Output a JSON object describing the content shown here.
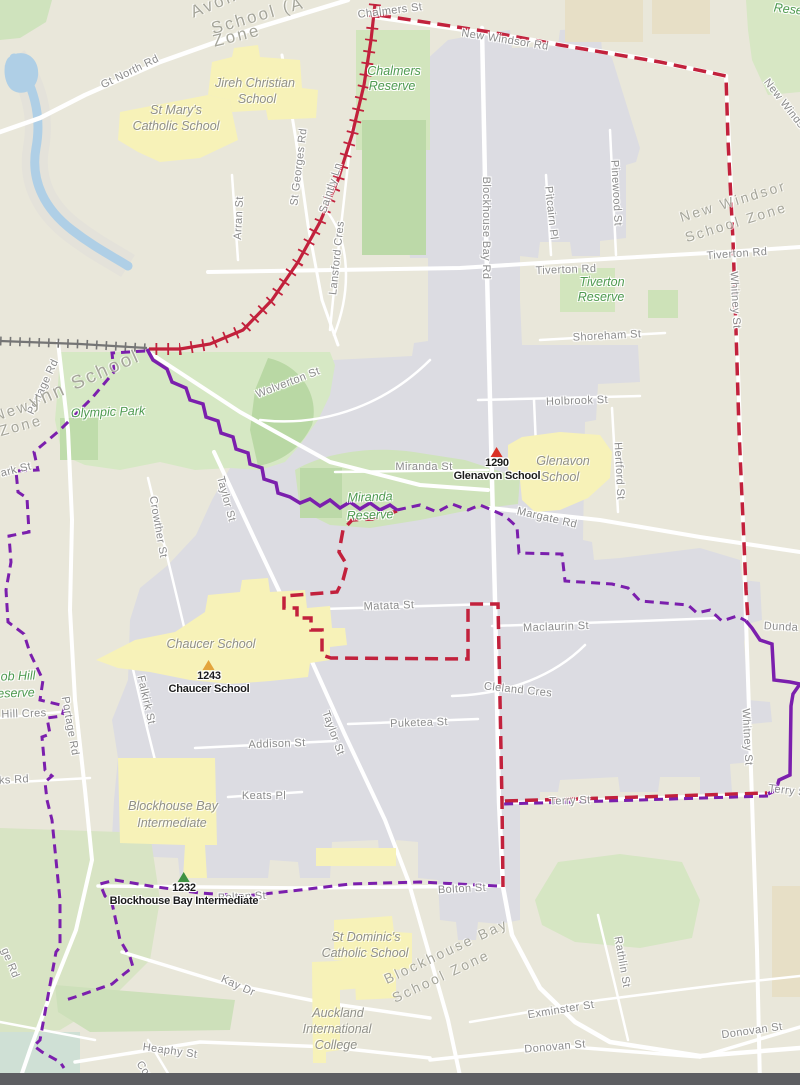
{
  "colors": {
    "land": "#e9e7da",
    "zone_fill": "#dcdce2",
    "park": "#d2e5bd",
    "park_dark": "#b9d8a4",
    "water": "#afcfe6",
    "teal": "#cfe0d5",
    "school_yellow": "#f7f2b8",
    "khaki": "#e7dfc6",
    "road": "#ffffff",
    "red_boundary": "#c2213c",
    "purple_boundary": "#7b1fad",
    "railway": "#757575",
    "bottom_bar": "#5d5e62"
  },
  "markers": [
    {
      "num": "1290",
      "name": "Glenavon School",
      "x": 497,
      "y": 447,
      "color": "#d93025"
    },
    {
      "num": "1243",
      "name": "Chaucer School",
      "x": 209,
      "y": 660,
      "color": "#e3a43c"
    },
    {
      "num": "1232",
      "name": "Blockhouse Bay Intermediate",
      "x": 184,
      "y": 872,
      "color": "#3f9142"
    }
  ],
  "labels": [
    {
      "t": "Chalmers St",
      "x": 390,
      "y": 11,
      "r": -7,
      "c": "st"
    },
    {
      "t": "New Windsor Rd",
      "x": 505,
      "y": 40,
      "r": 9,
      "c": "st"
    },
    {
      "t": "Gt North Rd",
      "x": 130,
      "y": 72,
      "r": -26,
      "c": "st"
    },
    {
      "t": "New Windsor Rd",
      "x": 793,
      "y": 115,
      "r": 52,
      "c": "st"
    },
    {
      "t": "St Georges Rd",
      "x": 299,
      "y": 167,
      "r": -83,
      "c": "st"
    },
    {
      "t": "Saintly Ln",
      "x": 331,
      "y": 188,
      "r": -72,
      "c": "st"
    },
    {
      "t": "Arran St",
      "x": 239,
      "y": 218,
      "r": -87,
      "c": "st"
    },
    {
      "t": "Lansford Cres",
      "x": 337,
      "y": 258,
      "r": -84,
      "c": "st"
    },
    {
      "t": "Blockhouse Bay Rd",
      "x": 486,
      "y": 228,
      "r": 90,
      "c": "st"
    },
    {
      "t": "Pitcairn Pl",
      "x": 551,
      "y": 213,
      "r": 84,
      "c": "st"
    },
    {
      "t": "Pinewood St",
      "x": 616,
      "y": 193,
      "r": 87,
      "c": "st"
    },
    {
      "t": "Tiverton Rd",
      "x": 566,
      "y": 270,
      "r": -2,
      "c": "st"
    },
    {
      "t": "Tiverton Rd",
      "x": 737,
      "y": 254,
      "r": -4,
      "c": "st"
    },
    {
      "t": "Whitney St",
      "x": 735,
      "y": 300,
      "r": 87,
      "c": "st"
    },
    {
      "t": "Shoreham St",
      "x": 607,
      "y": 336,
      "r": -3,
      "c": "st"
    },
    {
      "t": "Wolverton St",
      "x": 288,
      "y": 383,
      "r": -21,
      "c": "st"
    },
    {
      "t": "Holbrook St",
      "x": 577,
      "y": 401,
      "r": -2,
      "c": "st"
    },
    {
      "t": "Miranda St",
      "x": 424,
      "y": 467,
      "r": 0,
      "c": "st"
    },
    {
      "t": "Hertford St",
      "x": 619,
      "y": 471,
      "r": 87,
      "c": "st"
    },
    {
      "t": "Margate Rd",
      "x": 547,
      "y": 518,
      "r": 13,
      "c": "st"
    },
    {
      "t": "Crowther St",
      "x": 158,
      "y": 527,
      "r": 80,
      "c": "st"
    },
    {
      "t": "Taylor St",
      "x": 226,
      "y": 499,
      "r": 75,
      "c": "st"
    },
    {
      "t": "Matata St",
      "x": 389,
      "y": 606,
      "r": -2,
      "c": "st"
    },
    {
      "t": "Maclaurin St",
      "x": 556,
      "y": 627,
      "r": -2,
      "c": "st"
    },
    {
      "t": "Falkirk St",
      "x": 146,
      "y": 700,
      "r": 77,
      "c": "st"
    },
    {
      "t": "Cleland Cres",
      "x": 518,
      "y": 690,
      "r": 6,
      "c": "st"
    },
    {
      "t": "Puketea St",
      "x": 419,
      "y": 723,
      "r": -2,
      "c": "st"
    },
    {
      "t": "Addison St",
      "x": 277,
      "y": 744,
      "r": -2,
      "c": "st"
    },
    {
      "t": "Taylor St",
      "x": 333,
      "y": 733,
      "r": 70,
      "c": "st"
    },
    {
      "t": "Keats Pl",
      "x": 264,
      "y": 796,
      "r": 0,
      "c": "st"
    },
    {
      "t": "Whitney St",
      "x": 747,
      "y": 737,
      "r": 87,
      "c": "st"
    },
    {
      "t": "Terry St",
      "x": 789,
      "y": 791,
      "r": 7,
      "c": "st"
    },
    {
      "t": "Terry St",
      "x": 570,
      "y": 801,
      "r": -2,
      "c": "st"
    },
    {
      "t": "Dunda",
      "x": 781,
      "y": 627,
      "r": 3,
      "c": "st"
    },
    {
      "t": "Bolton St",
      "x": 242,
      "y": 897,
      "r": -3,
      "c": "st"
    },
    {
      "t": "Bolton St",
      "x": 462,
      "y": 889,
      "r": -3,
      "c": "st"
    },
    {
      "t": "Kay Dr",
      "x": 238,
      "y": 986,
      "r": 24,
      "c": "st"
    },
    {
      "t": "Heaphy St",
      "x": 170,
      "y": 1051,
      "r": 8,
      "c": "st"
    },
    {
      "t": "Rathlin St",
      "x": 622,
      "y": 962,
      "r": 80,
      "c": "st"
    },
    {
      "t": "Exminster St",
      "x": 561,
      "y": 1010,
      "r": -9,
      "c": "st"
    },
    {
      "t": "Donovan St",
      "x": 555,
      "y": 1047,
      "r": -5,
      "c": "st"
    },
    {
      "t": "Donovan St",
      "x": 752,
      "y": 1031,
      "r": -8,
      "c": "st"
    },
    {
      "t": "Portage Rd",
      "x": 43,
      "y": 387,
      "r": -65,
      "c": "st"
    },
    {
      "t": "Portage Rd",
      "x": 70,
      "y": 726,
      "r": 80,
      "c": "st"
    },
    {
      "t": "ge Rd",
      "x": 10,
      "y": 963,
      "r": 68,
      "c": "st"
    },
    {
      "t": "ark St",
      "x": 16,
      "y": 470,
      "r": -14,
      "c": "st"
    },
    {
      "t": "Hill Cres",
      "x": 24,
      "y": 714,
      "r": -2,
      "c": "st"
    },
    {
      "t": "ks Rd",
      "x": 14,
      "y": 780,
      "r": -3,
      "c": "st"
    },
    {
      "t": "Cor",
      "x": 144,
      "y": 1070,
      "r": 55,
      "c": "st"
    },
    {
      "t": "Avon",
      "x": 214,
      "y": 4,
      "r": -22,
      "c": "zn",
      "s": 17
    },
    {
      "t": "School (A",
      "x": 258,
      "y": 16,
      "r": -16,
      "c": "zn",
      "s": 17
    },
    {
      "t": "Zone",
      "x": 237,
      "y": 36,
      "r": -14,
      "c": "zn",
      "s": 17
    },
    {
      "t": "New Windsor",
      "x": 733,
      "y": 201,
      "r": -17,
      "c": "zn"
    },
    {
      "t": "School Zone",
      "x": 736,
      "y": 222,
      "r": -17,
      "c": "zn"
    },
    {
      "t": "ynn School",
      "x": 85,
      "y": 380,
      "r": -24,
      "c": "zn",
      "s": 19
    },
    {
      "t": "New",
      "x": 12,
      "y": 411,
      "r": -18,
      "c": "zn",
      "s": 15
    },
    {
      "t": "Zone",
      "x": 21,
      "y": 426,
      "r": -15,
      "c": "zn",
      "s": 15
    },
    {
      "t": "Blockhouse Bay",
      "x": 446,
      "y": 951,
      "r": -25,
      "c": "zn"
    },
    {
      "t": "School Zone",
      "x": 441,
      "y": 976,
      "r": -25,
      "c": "zn"
    },
    {
      "t": "Chalmers",
      "x": 394,
      "y": 71,
      "r": 0,
      "c": "rv"
    },
    {
      "t": "Reserve",
      "x": 392,
      "y": 86,
      "r": 0,
      "c": "rv"
    },
    {
      "t": "Reserve",
      "x": 797,
      "y": 10,
      "r": 6,
      "c": "rv"
    },
    {
      "t": "Tiverton",
      "x": 602,
      "y": 282,
      "r": 0,
      "c": "rv"
    },
    {
      "t": "Reserve",
      "x": 601,
      "y": 297,
      "r": 0,
      "c": "rv"
    },
    {
      "t": "Olympic Park",
      "x": 108,
      "y": 412,
      "r": -2,
      "c": "rv"
    },
    {
      "t": "Miranda",
      "x": 370,
      "y": 497,
      "r": -2,
      "c": "rv"
    },
    {
      "t": "Reserve",
      "x": 370,
      "y": 515,
      "r": -2,
      "c": "rv"
    },
    {
      "t": "ob Hill",
      "x": 18,
      "y": 676,
      "r": -2,
      "c": "rv"
    },
    {
      "t": "eserve",
      "x": 16,
      "y": 693,
      "r": -2,
      "c": "rv"
    },
    {
      "t": "Jireh Christian",
      "x": 255,
      "y": 83,
      "r": 0,
      "c": "sc"
    },
    {
      "t": "School",
      "x": 257,
      "y": 99,
      "r": 0,
      "c": "sc"
    },
    {
      "t": "St Mary's",
      "x": 176,
      "y": 110,
      "r": 0,
      "c": "sc"
    },
    {
      "t": "Catholic School",
      "x": 176,
      "y": 126,
      "r": 0,
      "c": "sc"
    },
    {
      "t": "Glenavon",
      "x": 563,
      "y": 461,
      "r": 0,
      "c": "sc"
    },
    {
      "t": "School",
      "x": 560,
      "y": 477,
      "r": 0,
      "c": "sc"
    },
    {
      "t": "Chaucer School",
      "x": 211,
      "y": 644,
      "r": 0,
      "c": "sc"
    },
    {
      "t": "Blockhouse Bay",
      "x": 173,
      "y": 806,
      "r": 0,
      "c": "sc"
    },
    {
      "t": "Intermediate",
      "x": 172,
      "y": 823,
      "r": 0,
      "c": "sc"
    },
    {
      "t": "St Dominic's",
      "x": 366,
      "y": 937,
      "r": 0,
      "c": "sc"
    },
    {
      "t": "Catholic School",
      "x": 365,
      "y": 953,
      "r": 0,
      "c": "sc"
    },
    {
      "t": "Auckland",
      "x": 338,
      "y": 1013,
      "r": 0,
      "c": "sc"
    },
    {
      "t": "International",
      "x": 337,
      "y": 1029,
      "r": 0,
      "c": "sc"
    },
    {
      "t": "College",
      "x": 336,
      "y": 1045,
      "r": 0,
      "c": "sc"
    }
  ]
}
